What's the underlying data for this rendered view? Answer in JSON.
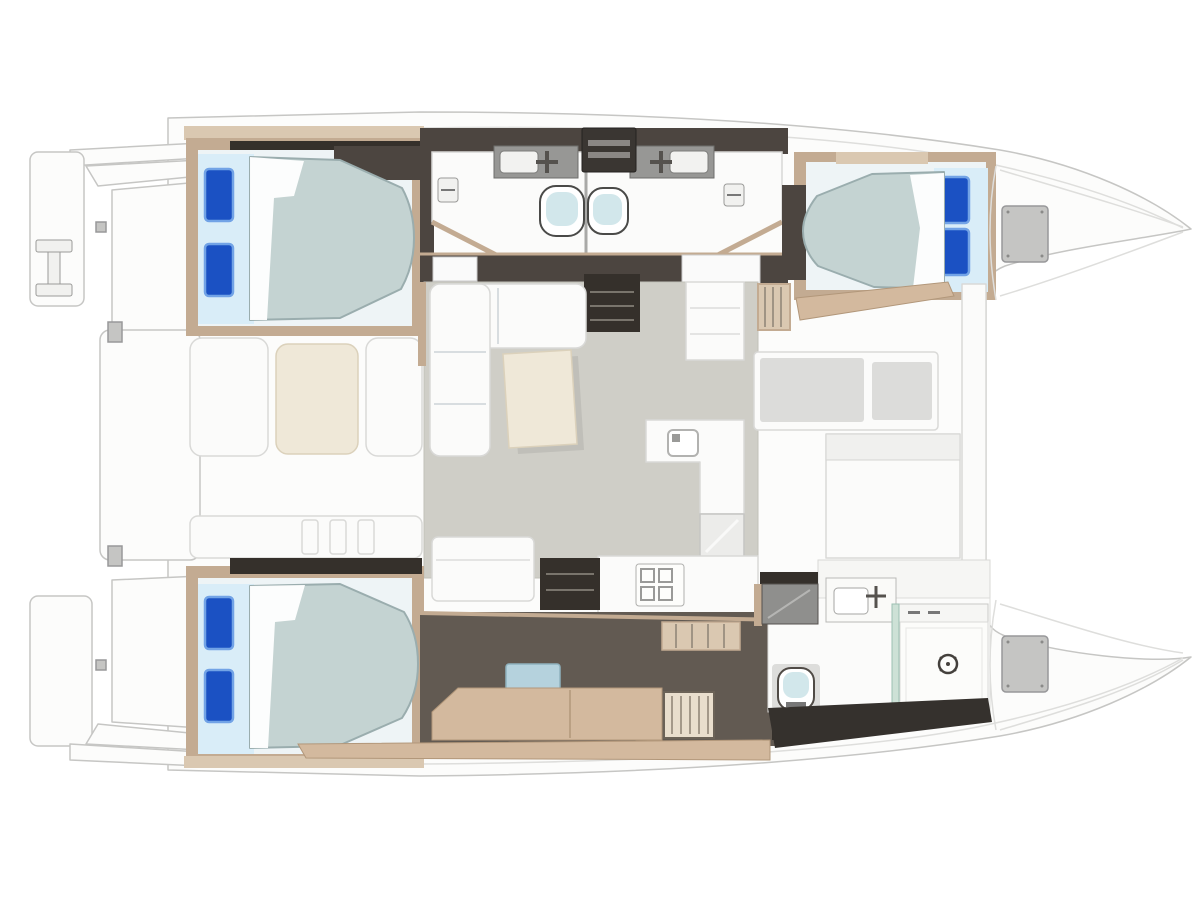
{
  "vessel": {
    "description": "Top-down deck floor plan of a sailing catamaran",
    "type": "catamaran",
    "view": "top-down floor plan",
    "hulls": 2,
    "double_beds": 3,
    "pillows_per_bed": 2,
    "toilets": 3,
    "sinks": 3,
    "showers": 1,
    "rooms": [
      "aft-port-cabin",
      "forward-port-cabin",
      "port-head-aft",
      "port-head-forward",
      "saloon",
      "galley",
      "forward-cockpit",
      "aft-cockpit",
      "owner-cabin-starboard",
      "owner-bathroom",
      "stern-platform",
      "bow-lockers"
    ],
    "furniture": [
      "double-bed",
      "l-shaped-sofa",
      "saloon-table",
      "chaise-lounge",
      "vanity-sink",
      "toilet",
      "shower",
      "cooktop",
      "steps",
      "locker",
      "davit-frame"
    ]
  },
  "palette": {
    "outline": "#c6c6c4",
    "outline_soft": "#dededc",
    "deck": "#fcfcfb",
    "wood": "#c3ab92",
    "wood_light": "#dac8b1",
    "wood_tan": "#d3b99e",
    "wall_dark": "#4c4540",
    "floor_dark": "#625a52",
    "near_black": "#35302b",
    "unit_gray": "#979795",
    "hatch_gray": "#c5c5c3",
    "cushion_gray": "#dcdcda",
    "mattress": "#c4d3d2",
    "mattress_edge": "#9aadae",
    "pillow_panel": "#d9edf8",
    "pillow_blue": "#1b51c3",
    "pillow_hi": "#72a3e6",
    "seat_blue": "#b5d2dd",
    "saloon_floor": "#cfcec7",
    "cream": "#efe8d8",
    "glass": "#cde1d6",
    "toilet_seat": "#d2e7eb"
  }
}
